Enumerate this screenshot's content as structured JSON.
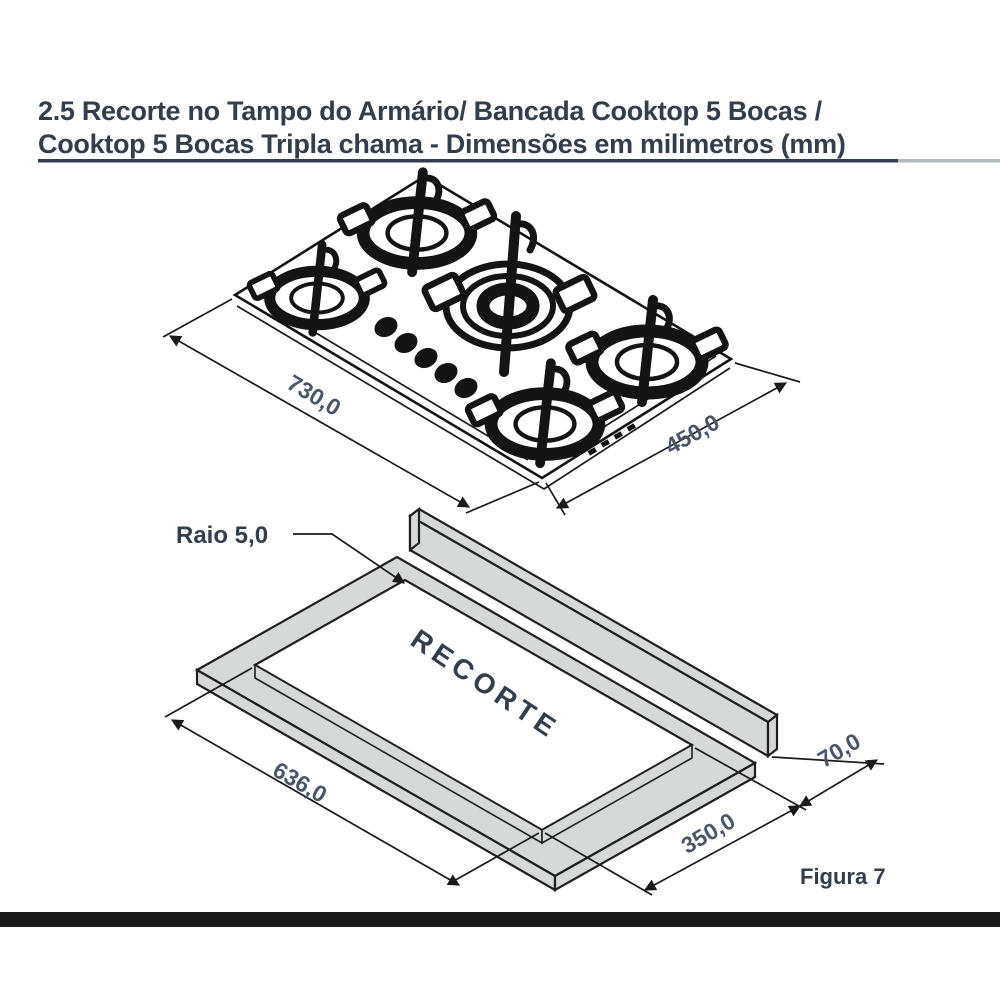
{
  "page": {
    "title_line1": "2.5 Recorte no Tampo do Armário/ Bancada Cooktop 5 Bocas /",
    "title_line2": "Cooktop 5 Bocas Tripla chama - Dimensões em milimetros (mm)"
  },
  "cooktop": {
    "width_label": "730,0",
    "depth_label": "450,0"
  },
  "cutout": {
    "radius_label": "Raio 5,0",
    "area_label": "RECORTE",
    "width_label": "636,0",
    "depth_label": "350,0",
    "offset_label": "70,0",
    "caption": "Figura 7"
  },
  "colors": {
    "title_text": "#333e4a",
    "dim_text": "#4a5668",
    "line": "#1a1a1a",
    "slab_fill": "#d7d8d8",
    "underline_dark": "#333e4a",
    "underline_light": "#b3b8bc",
    "bottom_bar": "#1a1a1a"
  }
}
